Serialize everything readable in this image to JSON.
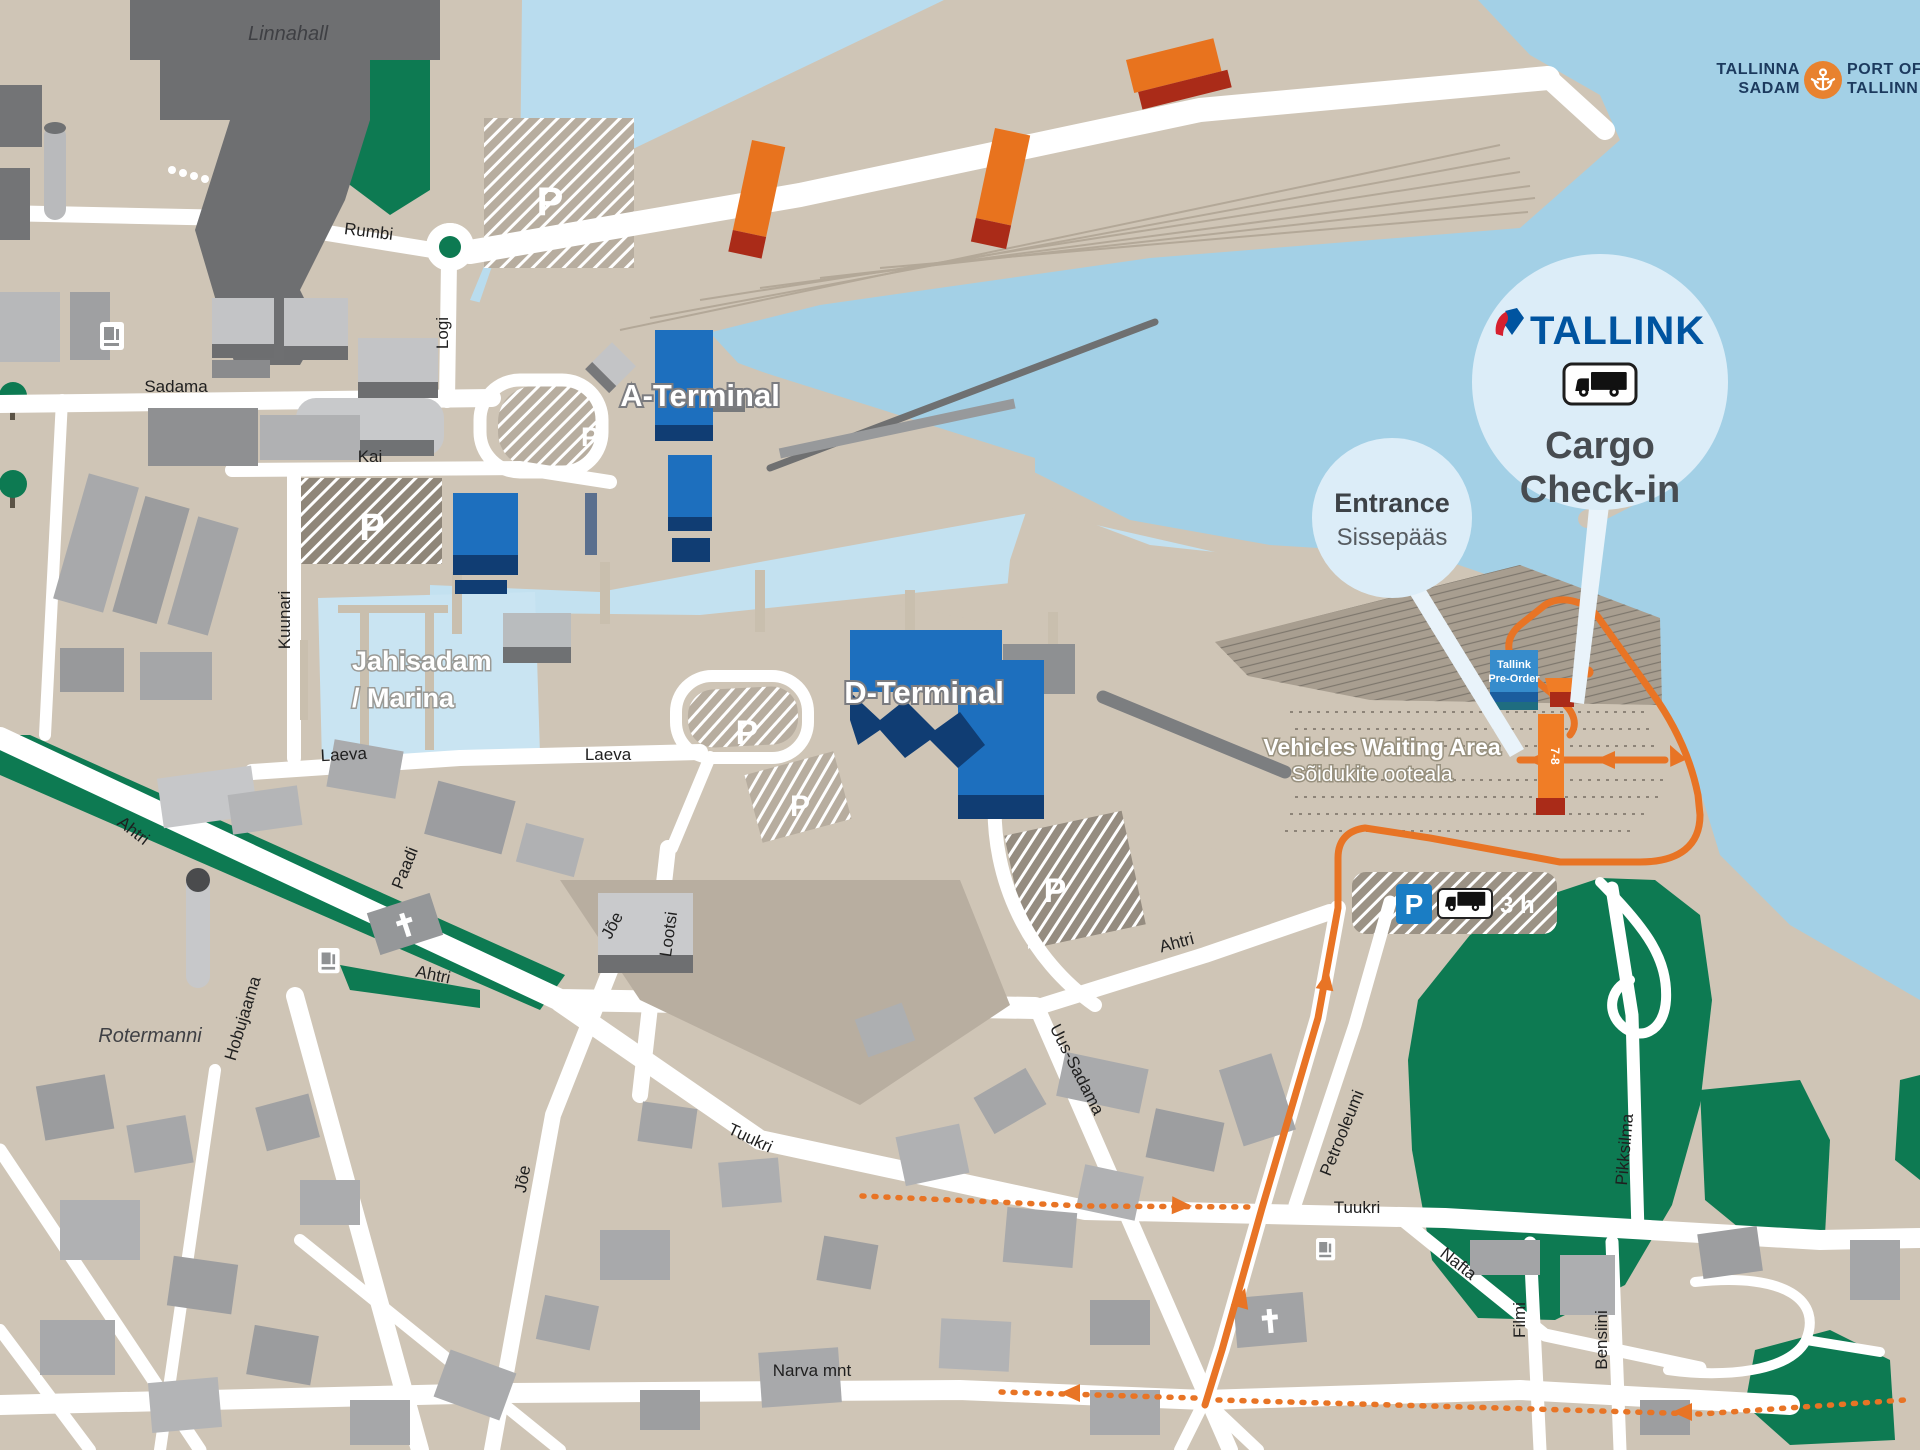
{
  "header": {
    "port_logo": {
      "tallinna": "TALLINNA",
      "sadam": "SADAM",
      "port_of": "PORT OF",
      "tallinn": "TALLINN"
    }
  },
  "callouts": {
    "cargo": {
      "brand": "TALLINK",
      "line1": "Cargo",
      "line2": "Check-in"
    },
    "entrance": {
      "title": "Entrance",
      "subtitle": "Sissepääs"
    }
  },
  "terminals": {
    "a": "A-Terminal",
    "d": "D-Terminal"
  },
  "areas": {
    "linnahall": "Linnahall",
    "marina_line1": "Jahisadam",
    "marina_line2": "/ Marina",
    "waiting_line1": "Vehicles Waiting Area",
    "waiting_line2": "Sõidukite ooteala",
    "rotermanni": "Rotermanni",
    "preorder_line1": "Tallink",
    "preorder_line2": "Pre-Order",
    "lanes": "7-8"
  },
  "parking": {
    "p": "P",
    "duration": "3 h"
  },
  "streets": {
    "rumbi": "Rumbi",
    "logi": "Logi",
    "sadama": "Sadama",
    "kai": "Kai",
    "kuunari": "Kuunari",
    "laeva": "Laeva",
    "ahtri": "Ahtri",
    "paadi": "Paadi",
    "hobujaama": "Hobujaama",
    "joe": "Jõe",
    "lootsi": "Lootsi",
    "tuukri": "Tuukri",
    "uus_sadama": "Uus-Sadama",
    "petrooleumi": "Petrooleumi",
    "nafta": "Nafta",
    "narva_mnt": "Narva mnt",
    "filmi": "Filmi",
    "bensiini": "Bensiini",
    "pikksilma": "Pikksilma"
  },
  "colors": {
    "route_orange": "#E87425",
    "tallink_blue": "#0054A0",
    "port_navy": "#1C3A5E",
    "terminal_blue": "#1D6FBE",
    "park_green": "#0D7A52",
    "water": "#A3D0E6",
    "land": "#CFC5B6"
  }
}
